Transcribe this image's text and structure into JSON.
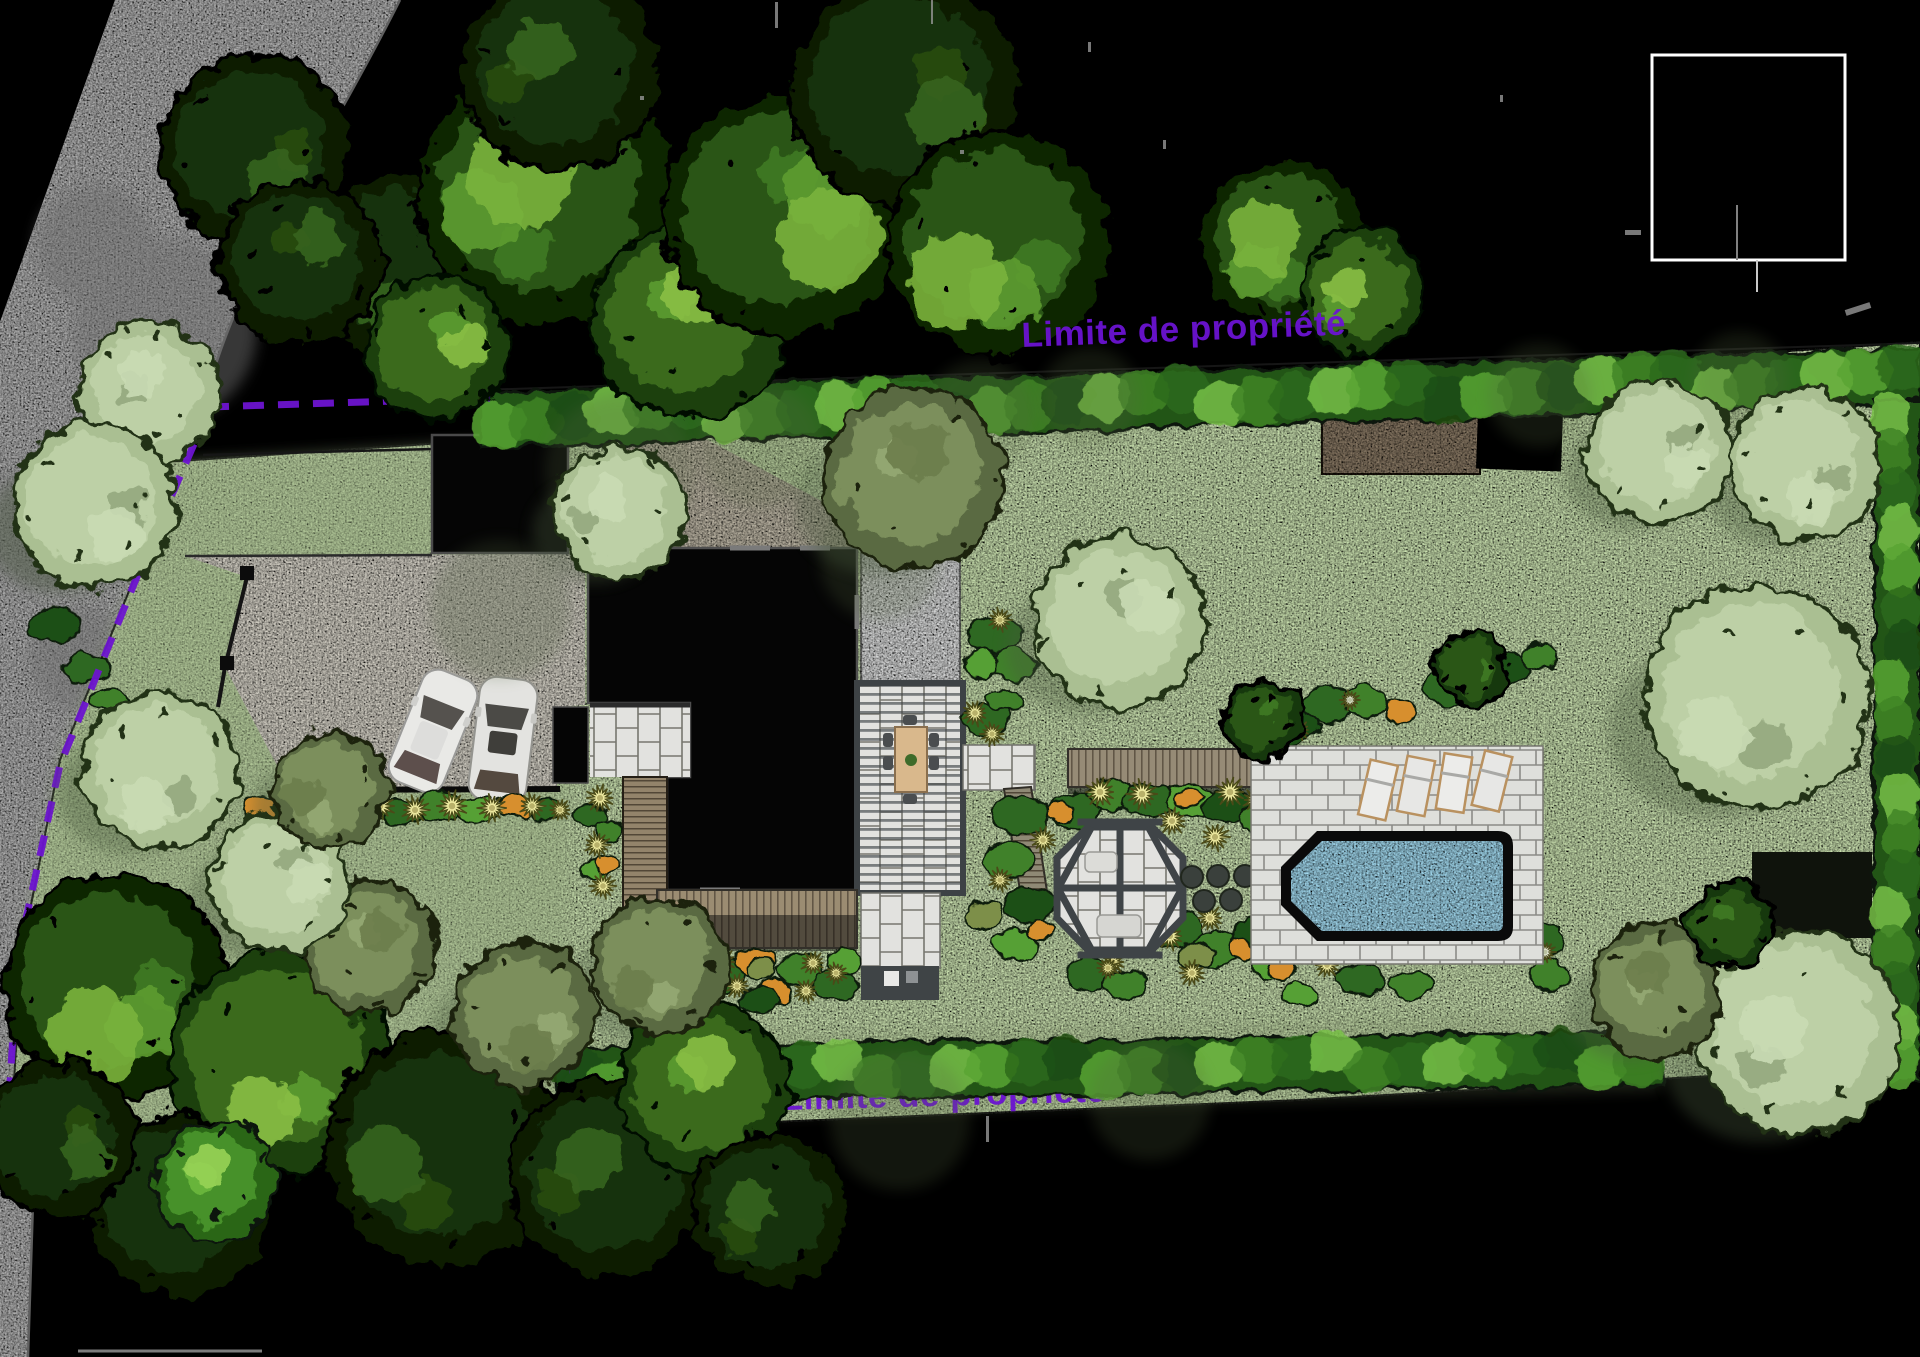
{
  "plan": {
    "labels": {
      "property_line_top": "Limite de propriété",
      "property_line_bottom": "Limite de propriété"
    },
    "palette": {
      "background": "#000000",
      "boundary_dashed": "#6d14d0",
      "road": "#b5b5b5",
      "lawn": "#cde4b2",
      "lawn_shadow": "#55663f",
      "gravel_driveway": "#d7d3c8",
      "canopy_dark": "#0a1d04",
      "canopy_mid": "#3a6b1e",
      "canopy_pale": "#b6cb9e",
      "hedge": "#245418",
      "stone_paving": "#dedfdb",
      "pool_water": "#a3daf0",
      "pool_coping": "#0a0a0a",
      "wood_deck": "#9b8c72",
      "soil_patch": "#8a7a66",
      "concrete_pad": "#dcdddd",
      "building": "#050505",
      "legend_border": "#ffffff"
    },
    "inventory": {
      "cars": 2,
      "sun_loungers": 4,
      "stepping_stones": 5,
      "sheds": 2,
      "pools": 1,
      "dining_tables": 1,
      "garden_pavilions": 1,
      "legend_box": "empty"
    }
  }
}
